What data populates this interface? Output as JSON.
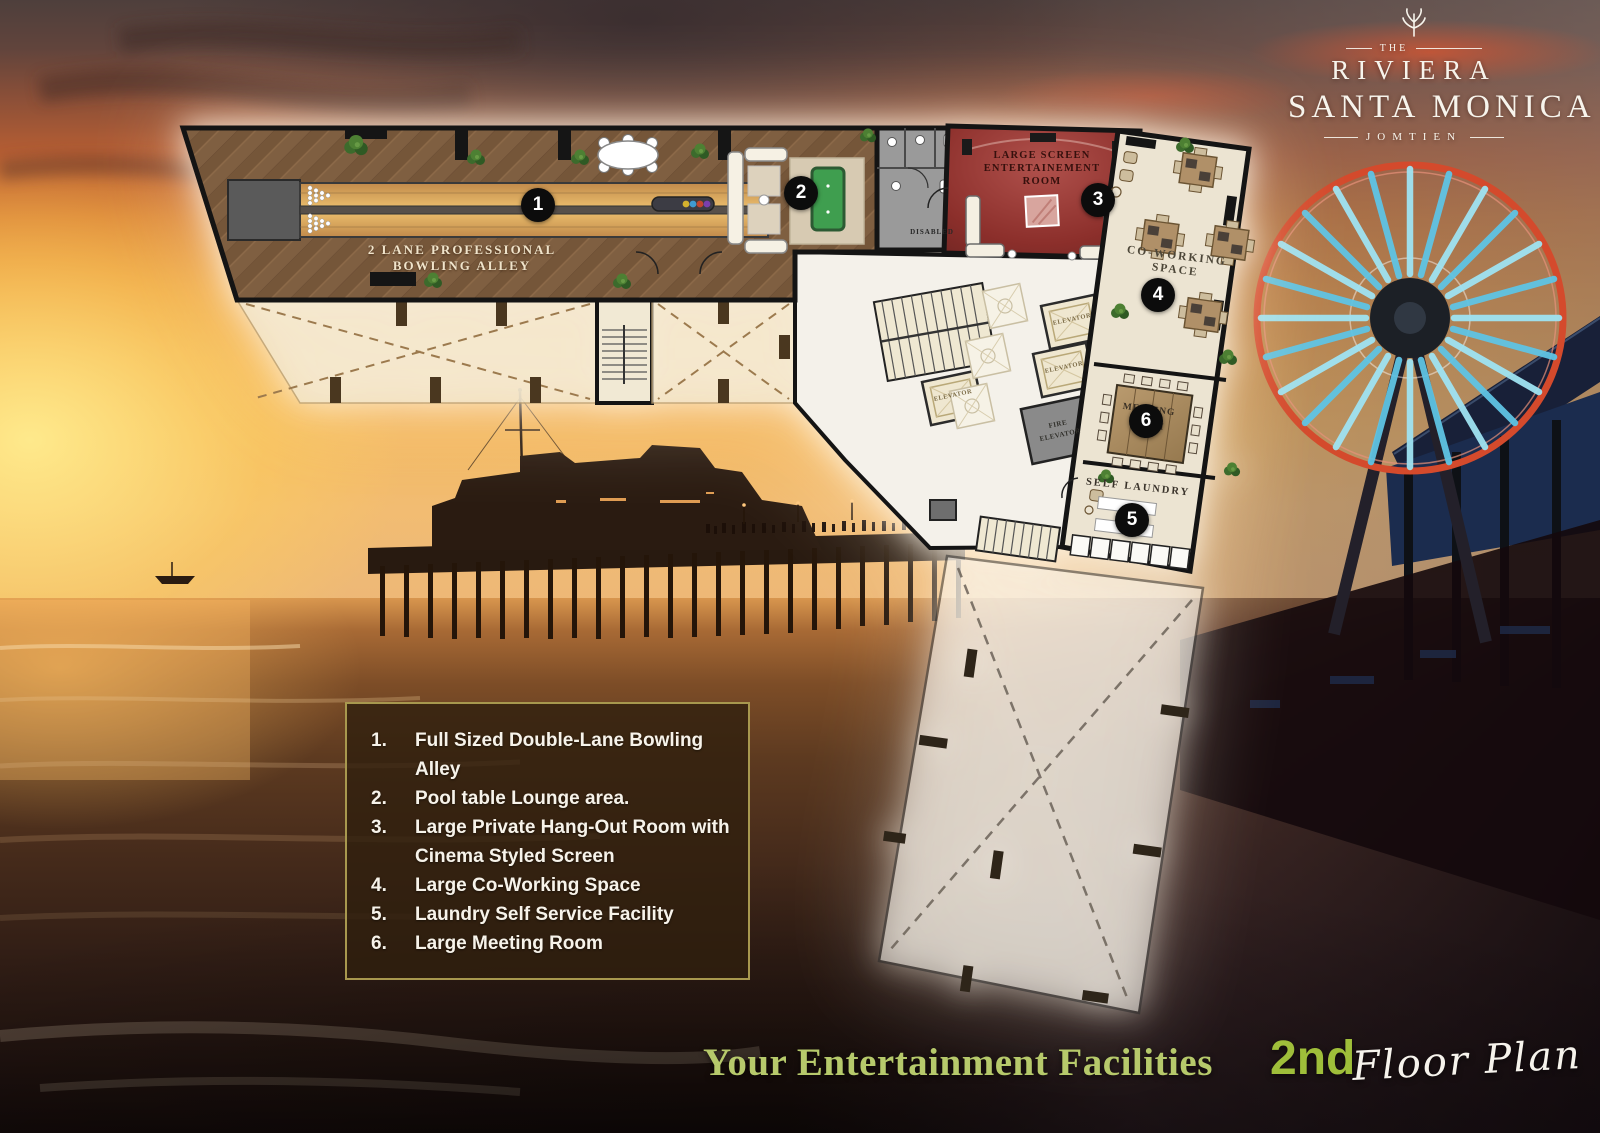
{
  "logo": {
    "the": "THE",
    "riviera": "RIVIERA",
    "santa_monica": "SANTA MONICA",
    "jomtien": "JOMTIEN"
  },
  "floor_plan": {
    "markers": [
      "1",
      "2",
      "3",
      "4",
      "5",
      "6"
    ],
    "rooms": {
      "bowling": {
        "label_line1": "2 LANE PROFESSIONAL",
        "label_line2": "BOWLING ALLEY"
      },
      "disabled": {
        "label": "DISABLED"
      },
      "entertainment": {
        "label_line1": "LARGE SCREEN",
        "label_line2": "ENTERTAINEMENT",
        "label_line3": "ROOM"
      },
      "coworking": {
        "label_line1": "CO-WORKING",
        "label_line2": "SPACE"
      },
      "meeting": {
        "label_line1": "MEETING",
        "label_line2": "ROOM"
      },
      "laundry": {
        "label": "SELF LAUNDRY"
      },
      "elevators": {
        "elevator": "ELEVATOR",
        "fire_line1": "FIRE",
        "fire_line2": "ELEVATOR"
      }
    }
  },
  "legend": {
    "items": [
      {
        "num": "1.",
        "text": "Full Sized Double-Lane Bowling Alley"
      },
      {
        "num": "2.",
        "text": "Pool table Lounge area."
      },
      {
        "num": "3.",
        "text": "Large Private Hang-Out Room with Cinema Styled Screen"
      },
      {
        "num": "4.",
        "text": "Large Co-Working Space"
      },
      {
        "num": "5.",
        "text": "Laundry Self Service Facility"
      },
      {
        "num": "6.",
        "text": "Large Meeting Room"
      }
    ]
  },
  "footer": {
    "title": "Your Entertainment Facilities",
    "floor_number": "2nd",
    "floor_label": "Floor Plan"
  },
  "colors": {
    "accent_green": "#9fbe3a",
    "title_green": "#b6c96b",
    "entertainment_red": "#93322e",
    "wheel_rim": "#d44a2c",
    "wheel_spoke": "#86d8ee",
    "legend_border": "#a8984e"
  }
}
